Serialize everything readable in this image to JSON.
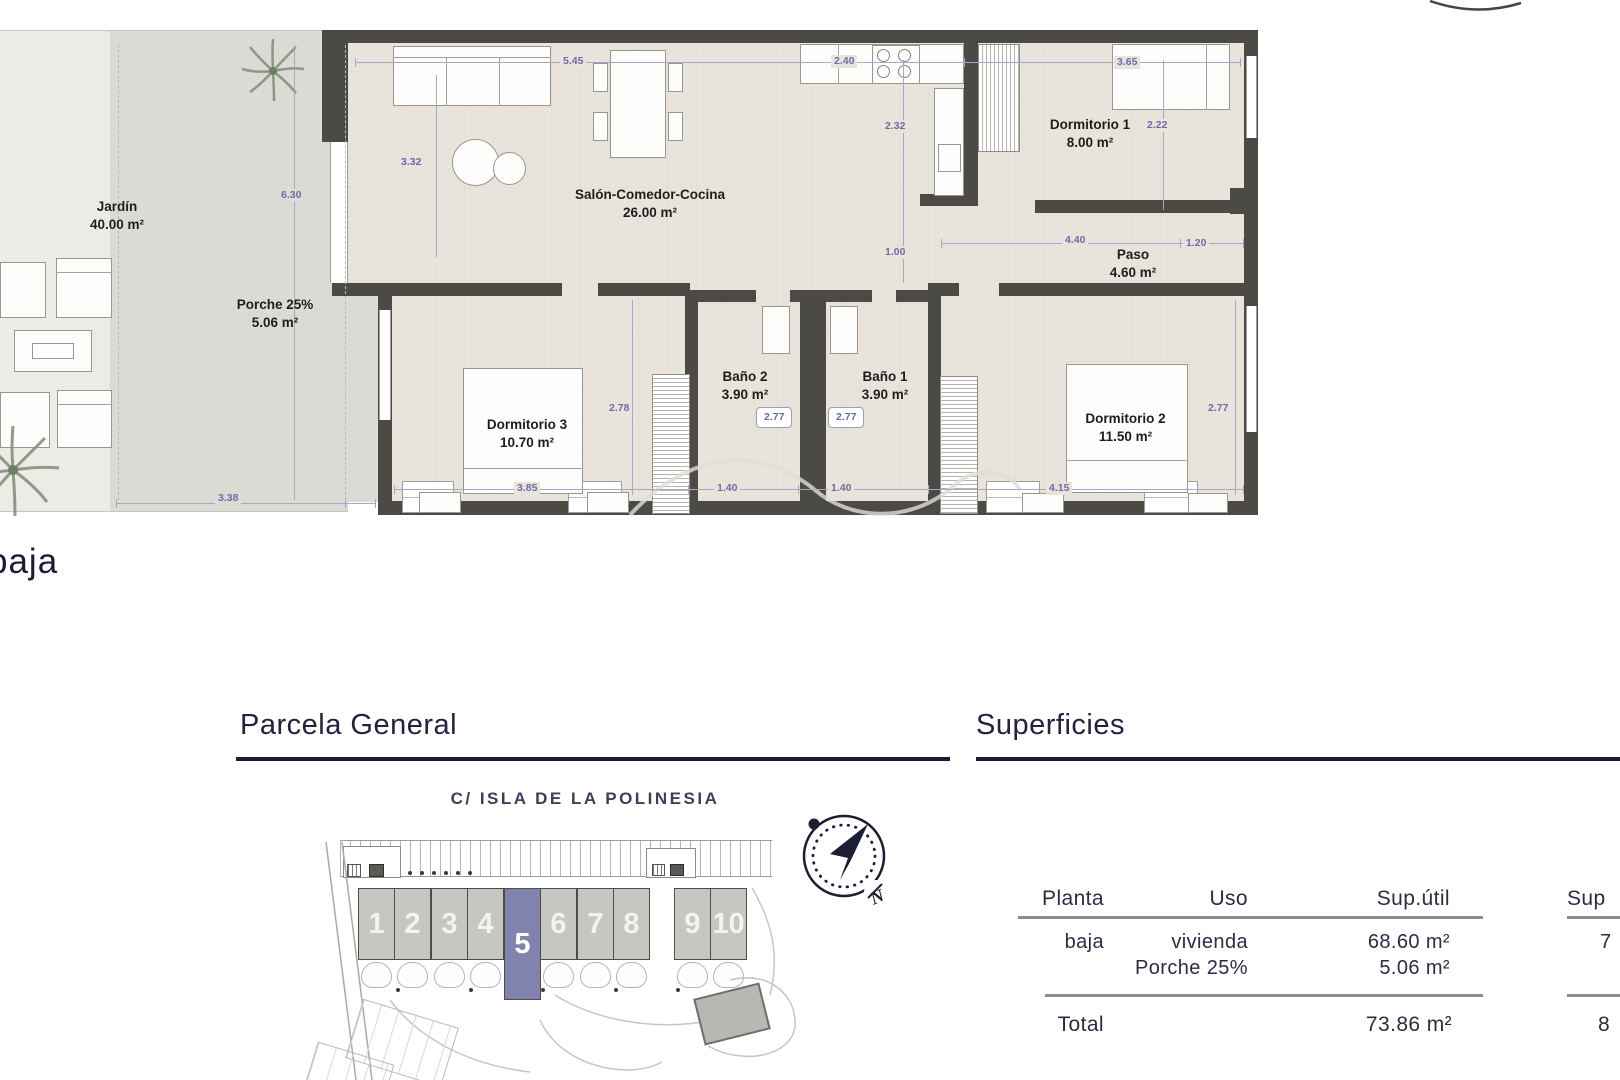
{
  "floor_plan": {
    "rooms": [
      {
        "name": "Jardín",
        "area": "40.00 m²"
      },
      {
        "name": "Porche 25%",
        "area": "5.06 m²"
      },
      {
        "name": "Salón-Comedor-Cocina",
        "area": "26.00 m²"
      },
      {
        "name": "Dormitorio 1",
        "area": "8.00 m²"
      },
      {
        "name": "Paso",
        "area": "4.60 m²"
      },
      {
        "name": "Baño 2",
        "area": "3.90 m²"
      },
      {
        "name": "Baño 1",
        "area": "3.90 m²"
      },
      {
        "name": "Dormitorio 3",
        "area": "10.70 m²"
      },
      {
        "name": "Dormitorio 2",
        "area": "11.50 m²"
      }
    ],
    "dimensions": {
      "top_a": "5.45",
      "top_b": "2.40",
      "top_c": "3.65",
      "salon_h": "3.32",
      "kitchen_h": "2.32",
      "dorm1_h": "2.22",
      "garden_h": "6.30",
      "pass_h": "1.00",
      "paso_w": "4.40",
      "paso_w2": "1.20",
      "dorm3_h": "2.78",
      "bano2_w": "2.77",
      "bano1_w": "2.77",
      "dorm2_h": "2.77",
      "dorm3_w": "3.85",
      "bano2_bw": "1.40",
      "bano1_bw": "1.40",
      "dorm2_w": "4.15",
      "garden_w": "3.38"
    }
  },
  "plan_label": "baja",
  "parcela": {
    "title": "Parcela General",
    "street": "C/ ISLA DE LA POLINESIA",
    "plots": [
      "1",
      "2",
      "3",
      "4",
      "5",
      "6",
      "7",
      "8",
      "9",
      "10"
    ],
    "highlighted_plot": "5",
    "compass_label": "N"
  },
  "superficies": {
    "title": "Superficies",
    "columns": [
      "Planta",
      "Uso",
      "Sup.útil",
      "Sup"
    ],
    "row": {
      "planta": "baja",
      "uso_line1": "vivienda",
      "uso_line2": "Porche 25%",
      "sup_util_line1": "68.60 m²",
      "sup_util_line2": "5.06 m²",
      "sup_const_line1": "7"
    },
    "total": {
      "label": "Total",
      "sup_util": "73.86 m²",
      "sup_const": "8"
    }
  },
  "colors": {
    "accent_navy": "#1c1c38",
    "wall": "#4b4a45",
    "plot_highlight": "#8282ae",
    "dim_blue": "#6c6ca8"
  }
}
